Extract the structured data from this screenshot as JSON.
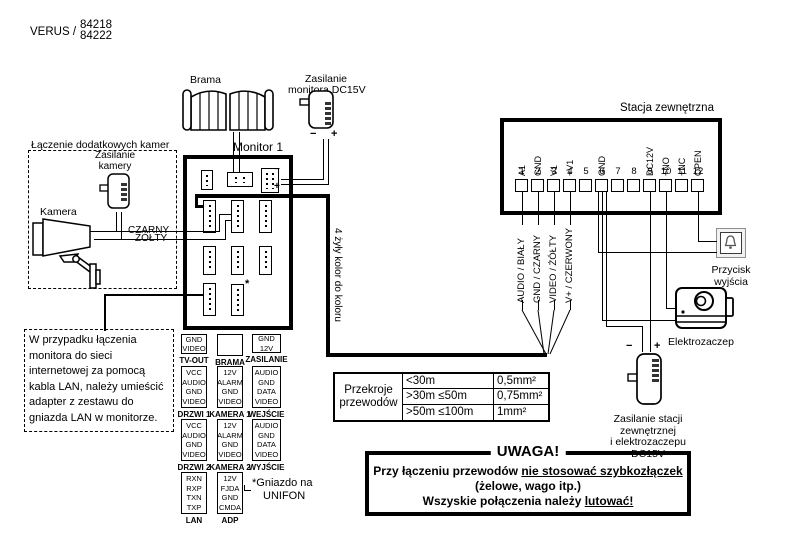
{
  "header": {
    "brand": "VERUS /",
    "models": [
      "84218",
      "84222"
    ]
  },
  "gate": {
    "label": "Brama"
  },
  "monitor_psu": {
    "label": [
      "Zasilanie",
      "monitora DC15V"
    ],
    "minus": "−",
    "plus": "+"
  },
  "monitor": {
    "title": "Monitor 1",
    "asterisk": "*",
    "conn_minus": "−",
    "conn_plus": "+"
  },
  "camera_section": {
    "title": "Łączenie dodatkowych kamer",
    "psu_label": [
      "Zasilanie",
      "kamery"
    ],
    "camera_label": "Kamera",
    "wire_black": "CZARNY",
    "wire_yellow": "ŻÓŁTY"
  },
  "lan_note": {
    "lines": [
      "W przypadku łączenia",
      "monitora do sieci",
      "internetowej za pomocą",
      "kabla LAN, należy umieścić",
      "adapter z zestawu do",
      "gniazda LAN w monitorze."
    ]
  },
  "cable_note": "4 żyły kolor do koloru",
  "connectors": [
    {
      "name": "TV-OUT",
      "pins": [
        "GND",
        "VIDEO"
      ]
    },
    {
      "name": "BRAMA",
      "pins": [
        "NO",
        "COM",
        "NC"
      ],
      "rotated": true
    },
    {
      "name": "ZASILANIE",
      "pins": [
        "GND",
        "12V"
      ]
    },
    {
      "name": "DRZWI 1",
      "pins": [
        "VCC",
        "AUDIO",
        "GND",
        "VIDEO"
      ]
    },
    {
      "name": "KAMERA 1",
      "pins": [
        "12V",
        "ALARM",
        "GND",
        "VIDEO"
      ]
    },
    {
      "name": "WEJŚCIE",
      "pins": [
        "AUDIO",
        "GND",
        "DATA",
        "VIDEO"
      ]
    },
    {
      "name": "DRZWI 2",
      "pins": [
        "VCC",
        "AUDIO",
        "GND",
        "VIDEO"
      ]
    },
    {
      "name": "KAMERA 2",
      "pins": [
        "12V",
        "ALARM",
        "GND",
        "VIDEO"
      ]
    },
    {
      "name": "WYJŚCIE",
      "pins": [
        "AUDIO",
        "GND",
        "DATA",
        "VIDEO"
      ]
    },
    {
      "name": "LAN",
      "pins": [
        "RXN",
        "RXP",
        "TXN",
        "TXP"
      ]
    },
    {
      "name": "ADP",
      "pins": [
        "12V",
        "FJDA",
        "GND",
        "CMDA"
      ]
    }
  ],
  "unifon_note": {
    "line1": "*Gniazdo na",
    "line2": "UNIFON"
  },
  "station": {
    "title": "Stacja zewnętrzna",
    "terminals": [
      {
        "num": "1",
        "label": "A1"
      },
      {
        "num": "2",
        "label": "GND"
      },
      {
        "num": "3",
        "label": "V1"
      },
      {
        "num": "4",
        "label": "+V1"
      },
      {
        "num": "5",
        "label": ""
      },
      {
        "num": "6",
        "label": "GND"
      },
      {
        "num": "7",
        "label": ""
      },
      {
        "num": "8",
        "label": ""
      },
      {
        "num": "9",
        "label": "DC12V"
      },
      {
        "num": "10",
        "label": "+NO"
      },
      {
        "num": "11",
        "label": "+NC"
      },
      {
        "num": "12",
        "label": "OPEN"
      }
    ]
  },
  "wire_labels": [
    "AUDIO / BIAŁY",
    "GND / CZARNY",
    "VIDEO / ŻÓŁTY",
    "V+ / CZERWONY"
  ],
  "exit_button": {
    "label": [
      "Przycisk",
      "wyjścia"
    ]
  },
  "strike": {
    "label": "Elektrozaczep"
  },
  "station_psu": {
    "label": [
      "Zasilanie stacji",
      "zewnętrznej",
      "i elektrozaczepu",
      "DC15V"
    ],
    "minus": "−",
    "plus": "+"
  },
  "cross_sections": {
    "header": [
      "Przekroje",
      "przewodów"
    ],
    "rows": [
      {
        "range": "<30m",
        "value": "0,5mm²"
      },
      {
        "range": ">30m ≤50m",
        "value": "0,75mm²"
      },
      {
        "range": ">50m ≤100m",
        "value": "1mm²"
      }
    ]
  },
  "warning": {
    "title": "UWAGA!",
    "line1": {
      "text": "Przy łączeniu przewodów ",
      "underlined": "nie stosować szybkozłączek"
    },
    "line2": "(żelowe, wago itp.)",
    "line3": {
      "text": "Wszyskie połączenia należy ",
      "underlined": "lutować!"
    }
  },
  "colors": {
    "line": "#000000",
    "background": "#ffffff"
  }
}
